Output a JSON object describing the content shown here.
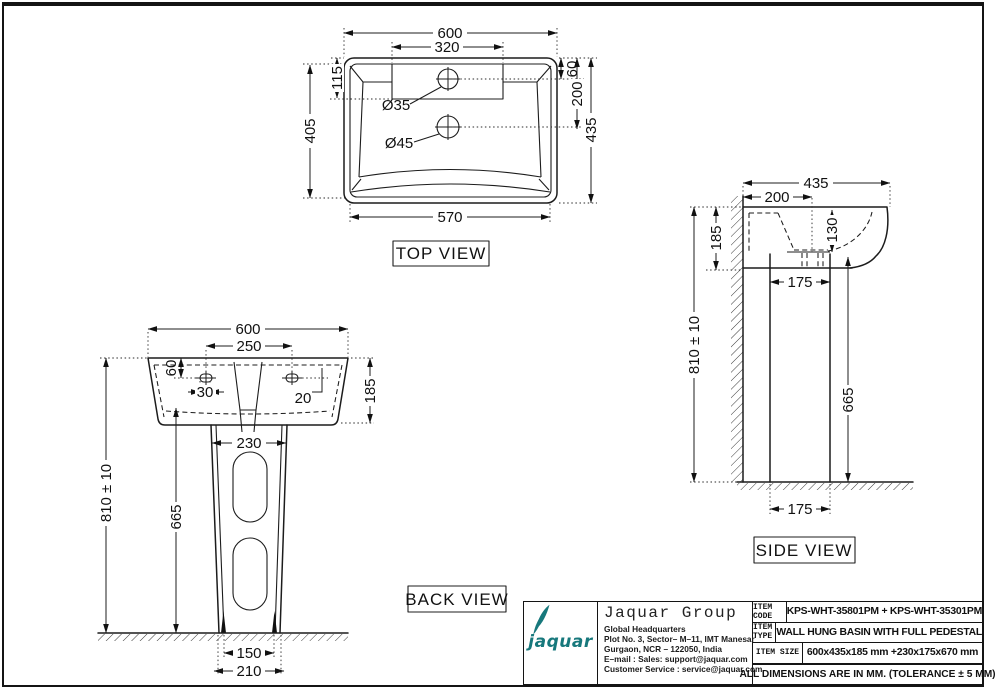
{
  "drawing": {
    "top_view": {
      "label": "TOP VIEW",
      "width": "600",
      "deck_width": "320",
      "deck_depth": "115",
      "hole1_drop": "60",
      "hole2_drop": "200",
      "depth_left": "405",
      "depth_right": "435",
      "front_width": "570",
      "hole1_dia": "Ø35",
      "hole2_dia": "Ø45"
    },
    "back_view": {
      "label": "BACK VIEW",
      "width": "600",
      "hole_spacing": "250",
      "hole_drop": "60",
      "hole_inset": "30",
      "hole_side": "20",
      "basin_height": "185",
      "pedestal_width": "230",
      "overall_height": "810 ± 10",
      "pedestal_height": "665",
      "foot_width": "150",
      "base_width": "210"
    },
    "side_view": {
      "label": "SIDE VIEW",
      "depth": "435",
      "drain_offset": "200",
      "basin_height": "185",
      "bowl_depth": "130",
      "pedestal_depth": "175",
      "overall_height": "810 ± 10",
      "pedestal_height": "665",
      "base_depth": "175"
    },
    "title_block": {
      "brand": "jaquar",
      "company": "Jaquar Group",
      "dept": "Global Headquarters",
      "address_line1": "Plot No. 3, Sector– M–11, IMT Manesar",
      "address_line2": "Gurgaon, NCR – 122050, India",
      "email_line": "E–mail : Sales: support@jaquar.com",
      "service_line": "Customer Service : service@jaquar.com",
      "rows": [
        {
          "label": "ITEM CODE",
          "value": "KPS-WHT-35801PM + KPS-WHT-35301PM"
        },
        {
          "label": "ITEM TYPE",
          "value": "WALL HUNG BASIN WITH FULL PEDESTAL"
        },
        {
          "label": "ITEM SIZE",
          "value": "600x435x185 mm +230x175x670 mm"
        }
      ],
      "note": "ALL DIMENSIONS ARE IN MM. (TOLERANCE ± 5 MM)",
      "brand_color": "#17787c"
    }
  }
}
